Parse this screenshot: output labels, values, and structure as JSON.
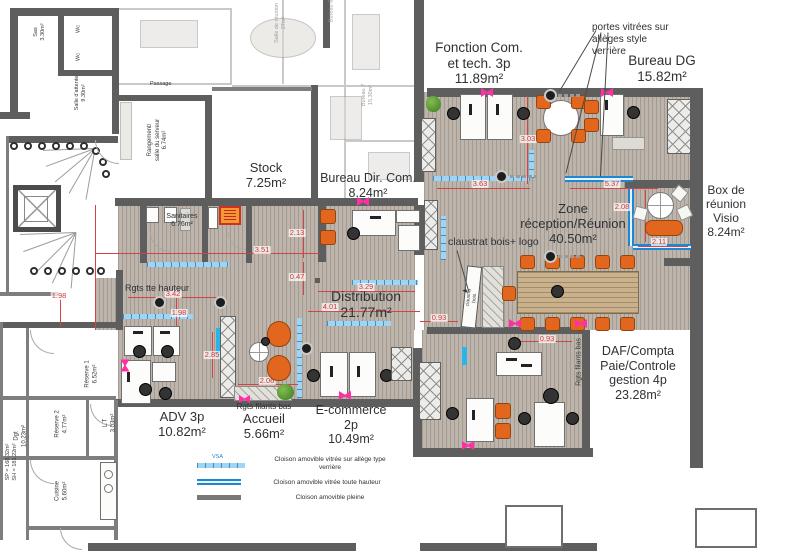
{
  "rooms": {
    "fonction_com": "Fonction Com.\net tech. 3p\n11.89m²",
    "bureau_dg": "Bureau DG\n15.82m²",
    "stock": "Stock\n7.25m²",
    "bureau_dir_com": "Bureau Dir. Com.\n8.24m²",
    "box_visio": "Box de\nréunion\nVisio\n8.24m²",
    "zone_reception": "Zone\nréception/Réunion\n40.50m²",
    "distribution": "Distribution\n21.77m²",
    "daf": "DAF/Compta\nPaie/Controle\ngestion 4p\n23.28m²",
    "adv": "ADV 3p\n10.82m²",
    "accueil": "Accueil\n5.66m²",
    "ecommerce": "E-commerce\n2p\n10.49m²"
  },
  "annotations": {
    "portes_vitrees": "portes vitrées sur\nallèges style\nverrière",
    "claustrat": "claustrat bois+ logo",
    "claustra_panel": "claustra bois",
    "rgts_tte_hauteur": "Rgts tte hauteur",
    "rgts_filants_bas": "Rgts filants bas",
    "rgts_filants_bas_v": "Rgts filants bas",
    "sanitaires": "Sanitaires\n6.76m²",
    "passage": "Passage",
    "sp_sh": "SP = 168.32m²\nSH = 181.22m²"
  },
  "existing_rooms": {
    "sas": "Sas\n3.30m²",
    "wc1": "Wc",
    "wc2": "Wc",
    "salle_attente": "Salle d'attente\n9.30m²",
    "rangement": "Rangement/\nsalle du serveur\n6.74m²",
    "reserve1": "Réserve 1\n6.52m²",
    "reserve2": "Réserve 2\n4.77m²",
    "lt": "L.T\n3.03m²",
    "dgt": "Dgt\n10.23m²",
    "cuisine": "Cuisine\n5.60m²",
    "salle_reunion": "Salle de réunion\n27m²",
    "bureau6": "Bureau 6",
    "bureau7": "Bureau 7\n15.30m²"
  },
  "dimensions": [
    "3.03",
    "3.63",
    "5.37",
    "2.08",
    "2.11",
    "2.13",
    "3.51",
    "0.47",
    "3.29",
    "4.01",
    "0.93",
    "0.93",
    "3.42",
    "1.98",
    "1.98",
    "2.85",
    "2.06"
  ],
  "legend": {
    "vsa": "VSA",
    "items": [
      {
        "label": "Cloison amovible vitrée sur allège type\nverrière"
      },
      {
        "label": "Cloison amovible vitrée toute hauteur"
      },
      {
        "label": "Cloison amovible pleine"
      }
    ]
  },
  "colors": {
    "allege_blue": "#9fd4f3",
    "full_height_blue": "#1f86d4",
    "cyan_partition": "#2ab5e8",
    "wall_gray": "#5e5e5e",
    "dimension_red": "#cf3838",
    "door_magenta": "#ff2fa6",
    "chair_orange": "#e2661d",
    "floor_taupe": "#bdb5ac"
  }
}
